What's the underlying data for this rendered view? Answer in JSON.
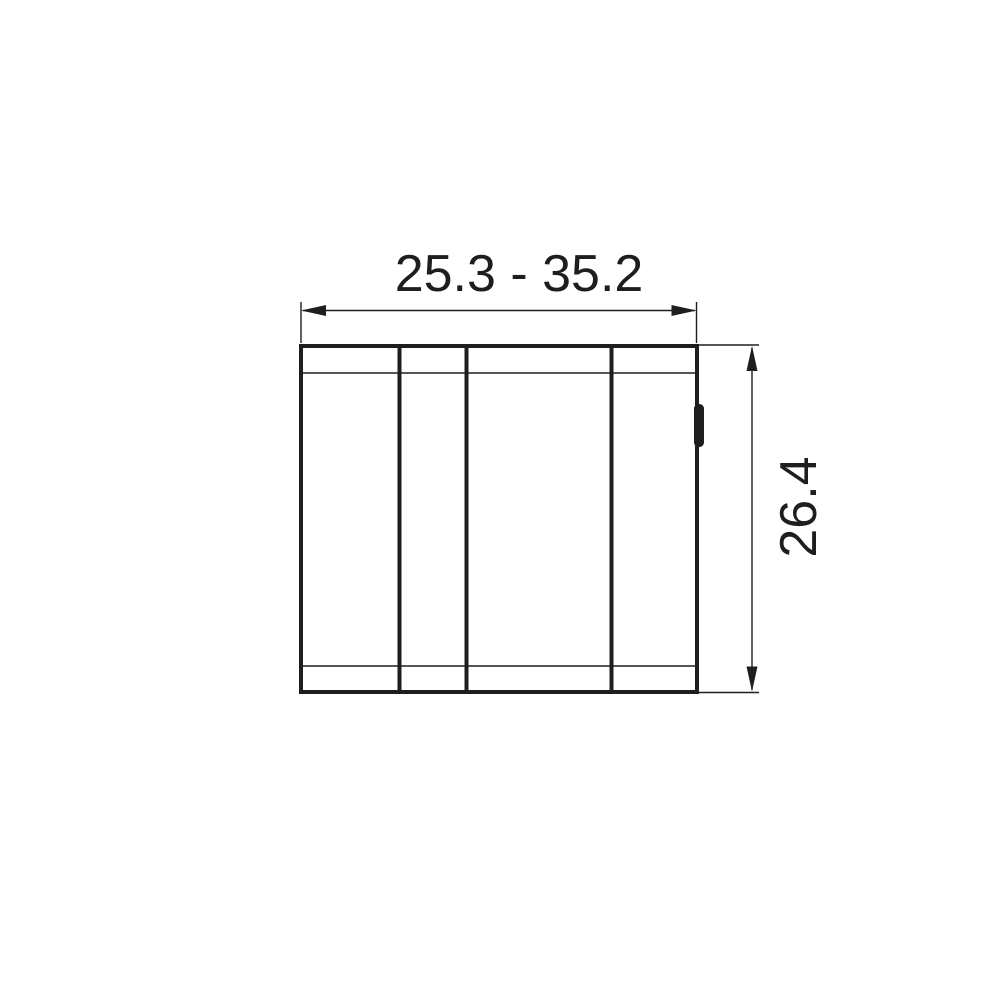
{
  "page": {
    "background": "#ffffff"
  },
  "drawing": {
    "type": "technical-dimension-drawing",
    "stroke_color": "#1e1e1c",
    "labels": {
      "width_range": "25.3 - 35.2",
      "height": "26.4"
    }
  }
}
